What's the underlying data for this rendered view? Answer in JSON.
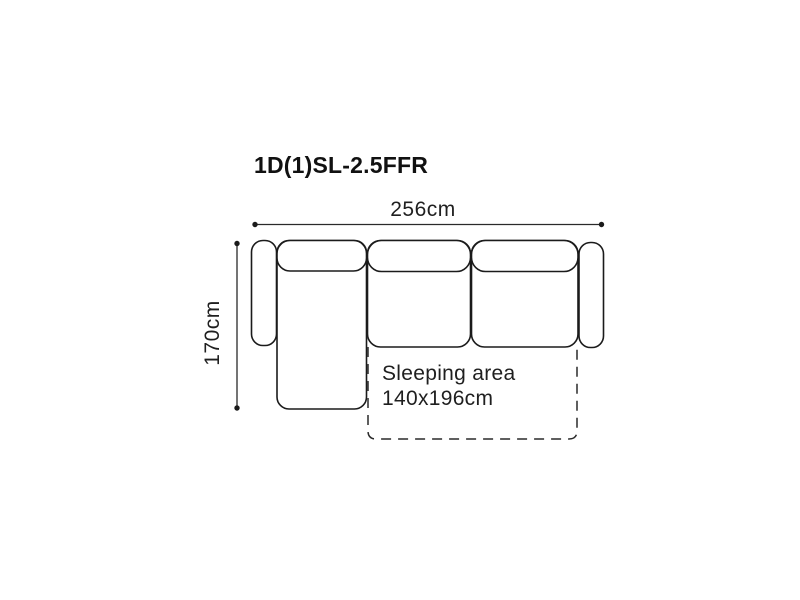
{
  "page": {
    "background": "#ffffff"
  },
  "diagram": {
    "title": "1D(1)SL-2.5FFR",
    "dimensions": {
      "width_label": "256cm",
      "height_label": "170cm"
    },
    "sleeping_area": {
      "line1": "Sleeping area",
      "line2": "140x196cm"
    },
    "colors": {
      "outline": "#1b1b1b",
      "dimension": "#2a2a2a",
      "text": "#1f1f1f",
      "title": "#111111",
      "fill": "#ffffff"
    }
  }
}
